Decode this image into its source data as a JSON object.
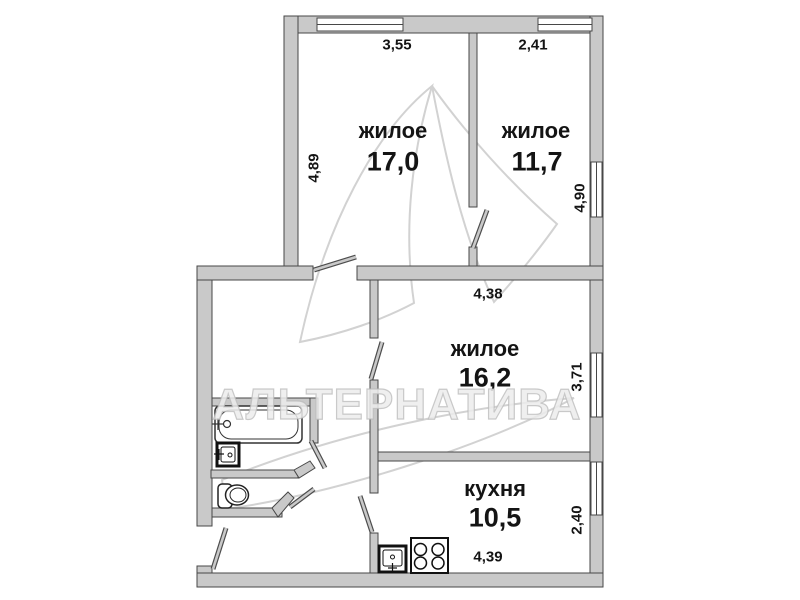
{
  "watermark": {
    "text": "АЛЬТЕРНАТИВА"
  },
  "rooms": [
    {
      "name": "жилое",
      "area": "17,0",
      "dim_w": "3,55",
      "dim_h": "4,89"
    },
    {
      "name": "жилое",
      "area": "11,7",
      "dim_w": "2,41",
      "dim_h": "4,90"
    },
    {
      "name": "жилое",
      "area": "16,2",
      "dim_w": "4,38",
      "dim_h": "3,71"
    },
    {
      "name": "кухня",
      "area": "10,5",
      "dim_w": "4,39",
      "dim_h": "2,40"
    }
  ],
  "fixtures": [
    "bathtub",
    "bathroom-sink",
    "toilet",
    "kitchen-sink",
    "stove"
  ],
  "colors": {
    "background": "#ffffff",
    "wall_fill": "#c9c9c9",
    "wall_stroke": "#474747",
    "label_text": "#141414",
    "watermark": "#d9d9d9"
  }
}
